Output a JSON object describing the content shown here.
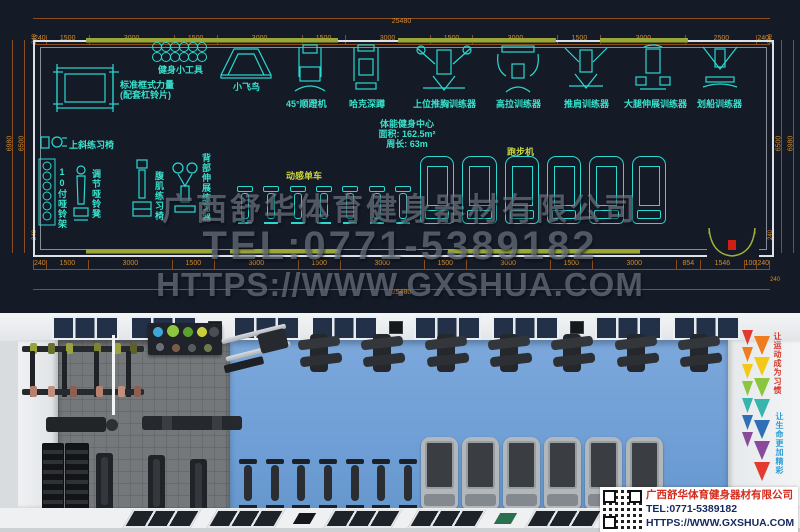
{
  "cad": {
    "dim_total_top": "25480",
    "dim_total_bottom": "25480",
    "dims_top": [
      "240",
      "1500",
      "3000",
      "1500",
      "3000",
      "1500",
      "3000",
      "1500",
      "3000",
      "1500",
      "3000",
      "2500",
      "240"
    ],
    "dims_bottom": [
      "240",
      "1500",
      "3000",
      "1500",
      "3000",
      "1500",
      "3000",
      "1500",
      "3000",
      "1500",
      "3000",
      "854",
      "1546",
      "100",
      "240"
    ],
    "dim_right_extra": "240",
    "v_left_outer": "6980",
    "v_left_inner": "6500",
    "v_right_inner": "6500",
    "v_right_outer": "6980",
    "corner_dim": "240",
    "labels": {
      "tools": "健身小工具",
      "rack_line1": "标准框式力量",
      "rack_line2": "(配套杠铃片)",
      "flybird": "小飞鸟",
      "legpress45": "45°顺蹬机",
      "hack": "哈克深蹲",
      "chestpress": "上位推胸训练器",
      "latpull": "高拉训练器",
      "shoulderpress": "推肩训练器",
      "legext": "大腿伸展训练器",
      "rowing": "划船训练器",
      "incline": "上斜练习椅",
      "dbrack": "10付哑铃架",
      "adjbench": "调节哑铃凳",
      "abchair": "腹肌练习椅",
      "backext": "背部伸展练习器",
      "spinbike": "动感单车",
      "treadmill": "跑步机"
    },
    "info": {
      "line1": "体能健身中心",
      "line2": "面积: 162.5m²",
      "line3": "周长: 63m"
    },
    "watermark": {
      "company": "广西舒华体育健身器材有限公司",
      "tel": "TEL:0771-5389182",
      "url": "HTTPS://WWW.GXSHUA.COM"
    },
    "bikes_count": 7,
    "treadmills_count": 6,
    "colors": {
      "line_cyan": "#2bd9d2",
      "label_cyan": "#38e2cc",
      "label_yellow": "#c9d33e",
      "dim_text": "#d18a2c",
      "window_olive": "#9aa637",
      "background": "#141a26"
    }
  },
  "render": {
    "banner": {
      "top_text": "让运动成为习惯",
      "bottom_text": "让生命更加精彩",
      "colors": [
        "#e23a2e",
        "#ef7d20",
        "#f2c918",
        "#8cc63f",
        "#35b5ab",
        "#2f6fb5",
        "#8a4a9b"
      ]
    },
    "card": {
      "company": "广西舒华体育健身器材有限公司",
      "tel": "TEL:0771-5389182",
      "url": "HTTPS://WWW.GXSHUA.COM"
    },
    "bikes_count": 7,
    "treadmills_count": 6,
    "machines_count": 7,
    "skylights_count": 8,
    "colors": {
      "blue_floor": "#6f9fd6",
      "gray_floor": "#75787b",
      "logo_red": "#d62b1c",
      "logo_navy": "#16295f"
    }
  }
}
